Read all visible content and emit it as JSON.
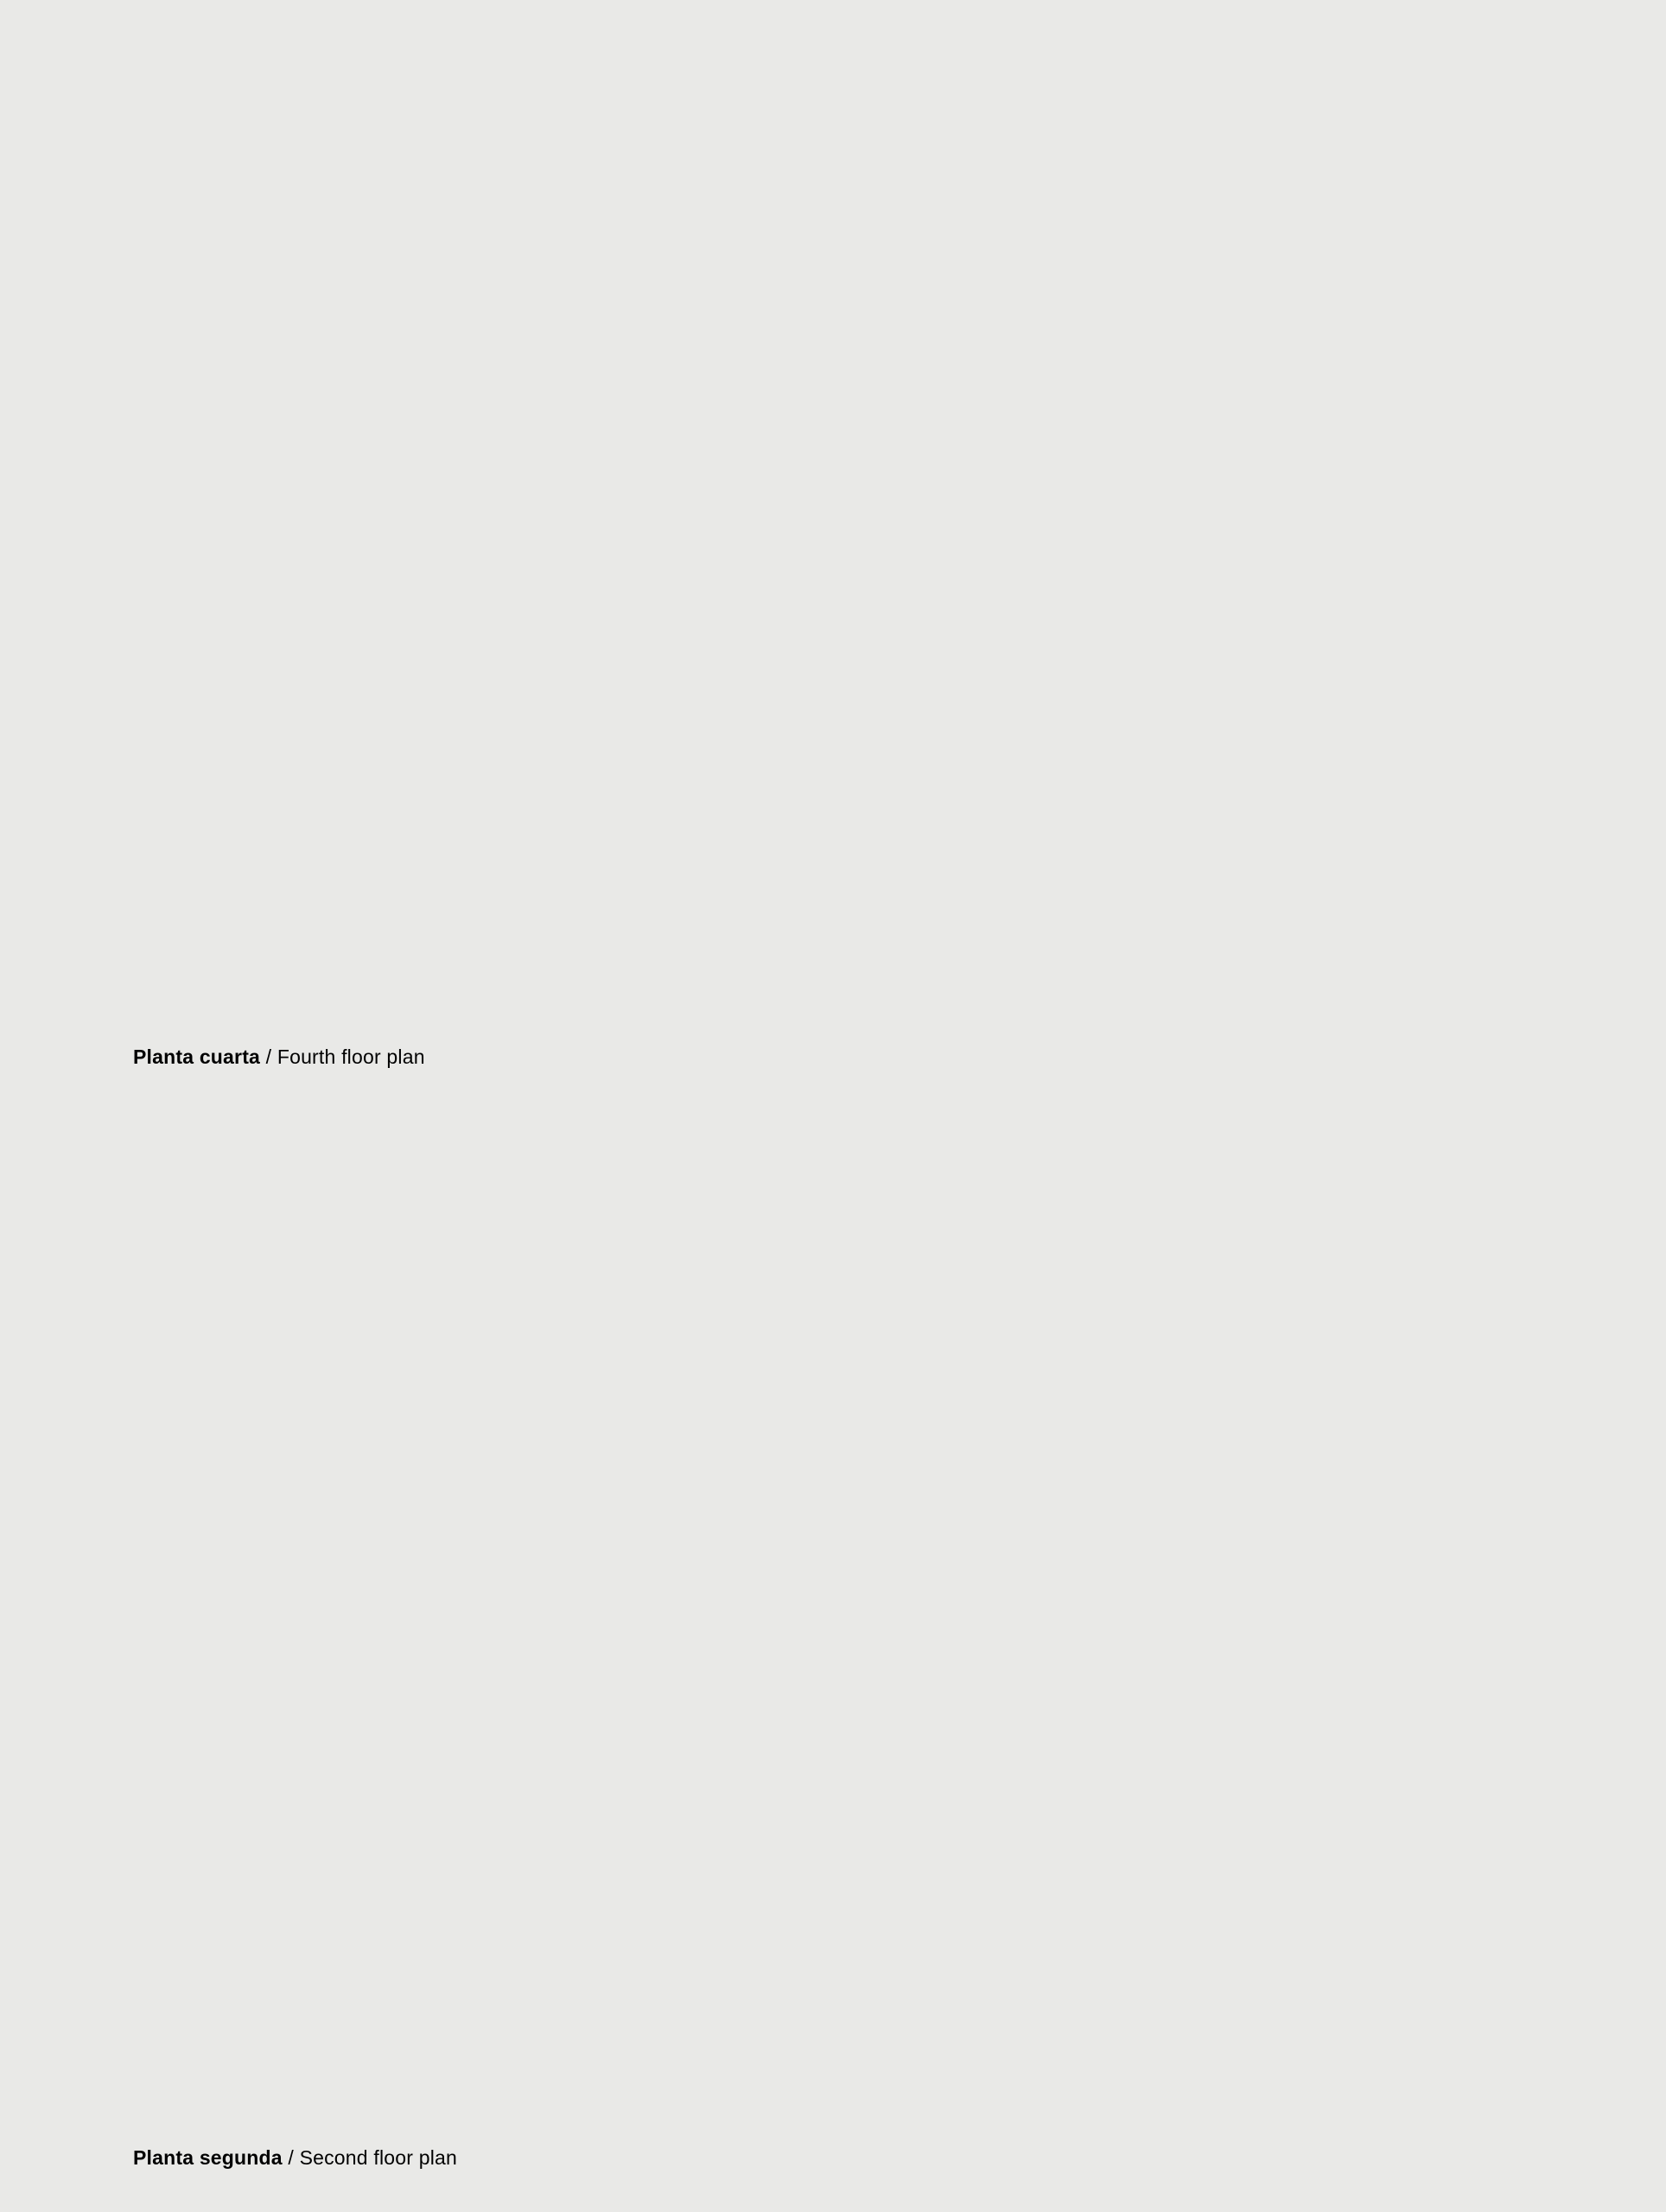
{
  "page": {
    "paper": "#f6f6f4",
    "building_fill": "#fcfcfb",
    "ink": "#3a3a3a",
    "wall": "#4e4e4e",
    "line": "#707070",
    "faint": "#9a9a9a",
    "bubble_stroke": "#858585",
    "caption_color": "#121212",
    "terrace_fill": "#f1f1ee"
  },
  "plans": [
    {
      "id": "fourth-floor-plan",
      "caption": {
        "title_es": "Planta cuarta",
        "separator": " / ",
        "title_en": "Fourth floor plan"
      }
    },
    {
      "id": "second-floor-plan",
      "caption": {
        "title_es": "Planta segunda",
        "separator": " / ",
        "title_en": "Second floor plan"
      }
    }
  ]
}
